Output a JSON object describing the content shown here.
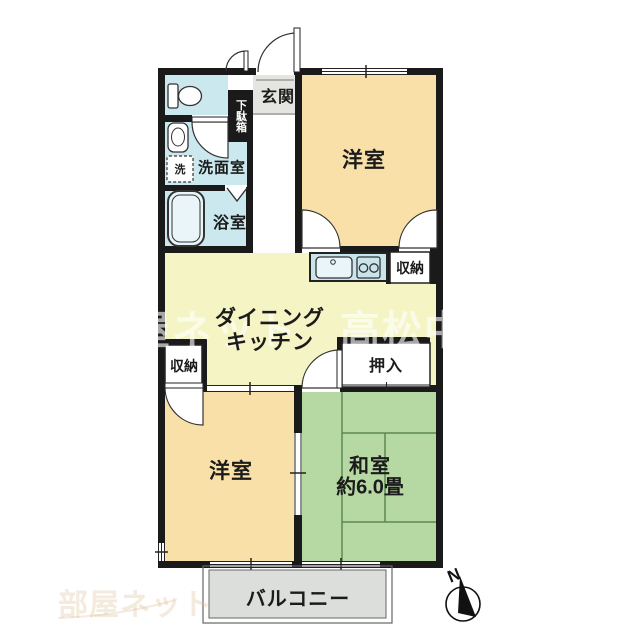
{
  "colors": {
    "wall": "#1a1a1a",
    "room_cream": "#F8E0A8",
    "room_yellow": "#F4F4C4",
    "room_green": "#B6D9A4",
    "room_cyan": "#CBE8EF",
    "counter_cyan": "#C9E4EB",
    "fixture_fill": "#E9F5F8",
    "entry_gray": "#E4E4E1",
    "balcony_gray": "#DCDEDC",
    "tatami_line": "#4F7A43"
  },
  "labels": {
    "genkan": "玄関",
    "getabako": "下駄箱",
    "senmenshitsu": "洗面室",
    "laundry": "洗",
    "yokushitsu": "浴室",
    "yoshitsu_top": "洋室",
    "shuno_kitchen": "収納",
    "dk_line1": "ダイニング",
    "dk_line2": "キッチン",
    "shuno_left": "収納",
    "oshiire": "押入",
    "yoshitsu_bottom": "洋室",
    "washitsu": "和室",
    "washitsu_size": "約6.0畳",
    "balcony": "バルコニー",
    "compass": "N"
  },
  "watermark": {
    "left": "屋ネット",
    "right": "高松中央",
    "corner": "部屋ネット"
  }
}
